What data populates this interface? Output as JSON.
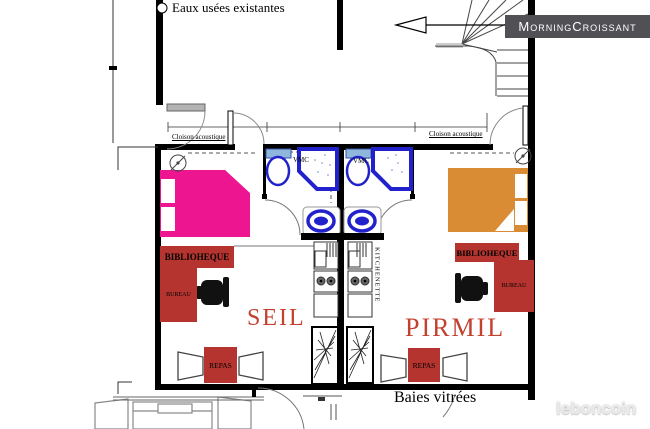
{
  "watermarks": {
    "morningcroissant": "MorningCroissant",
    "leboncoin": "leboncoin"
  },
  "plan": {
    "eaux_usees": "Eaux usées existantes",
    "cloison_acoustique_left": "Cloison acoustique",
    "cloison_acoustique_right": "Cloison acoustique",
    "baies_vitrees": "Baies vitrées",
    "kitchenette": "KITCHENETTE",
    "vmc_left": "VMC",
    "vmc_right": "VMC"
  },
  "units": {
    "seil": {
      "name": "SEIL",
      "bibliotheque": "BIBLIOHEQUE",
      "bureau": "BUREAU",
      "repas": "REPAS"
    },
    "pirmil": {
      "name": "PIRMIL",
      "bibliotheque": "BIBLIOHEQUE",
      "bureau": "BUREAU",
      "repas": "REPAS"
    }
  },
  "colors": {
    "bed_pink": "#ED1690",
    "bed_orange": "#D98C33",
    "furniture_red": "#B5342F",
    "label_red": "#C4402F",
    "bath_blue": "#2222CC",
    "tank_blue": "#8FB7DB",
    "wall": "#000000",
    "watermark_bg": "#515155"
  }
}
